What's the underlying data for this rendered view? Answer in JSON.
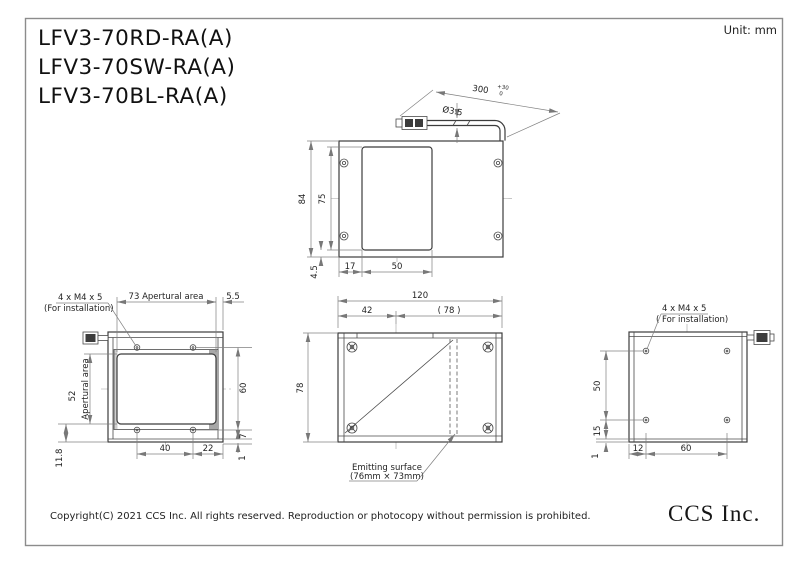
{
  "titles": {
    "m1": "LFV3-70RD-RA(A)",
    "m2": "LFV3-70SW-RA(A)",
    "m3": "LFV3-70BL-RA(A)"
  },
  "header": {
    "unit": "Unit: mm"
  },
  "footer": {
    "copyright": "Copyright(C) 2021 CCS Inc. All rights reserved. Reproduction or photocopy without permission is prohibited.",
    "logo": "CCS Inc."
  },
  "top_view": {
    "d84": "84",
    "d75": "75",
    "d4_5": "4.5",
    "d17": "17",
    "d50": "50",
    "cable_dia": "Ø3.5",
    "cable_len": "300",
    "cable_tol_up": "+30",
    "cable_tol_dn": "0"
  },
  "front_view": {
    "screws1": "4 x M4 x 5",
    "screws2": "(For installation)",
    "d73": "73 Apertural area",
    "d5_5": "5.5",
    "aperture": "Apertural area",
    "d52": "52",
    "d60": "60",
    "d7": "7",
    "d40": "40",
    "d22": "22",
    "d1": "1",
    "d11_8": "11.8"
  },
  "side_view": {
    "d120": "120",
    "d42": "42",
    "d78_ref": "( 78 )",
    "d78": "78",
    "emit1": "Emitting surface",
    "emit2": "(76mm × 73mm)"
  },
  "back_view": {
    "screws1": "4 x M4 x 5",
    "screws2": "( For installation)",
    "d50": "50",
    "d15": "15",
    "d1": "1",
    "d12": "12",
    "d60": "60"
  },
  "colors": {
    "object_line": "#3c3c3c",
    "dimension_line": "#808080",
    "text": "#1f1f1f",
    "frame_border": "#8c8c8c",
    "shade_dark": "#a8a8a8",
    "shade_light": "#cfcfcf",
    "background": "#ffffff"
  }
}
